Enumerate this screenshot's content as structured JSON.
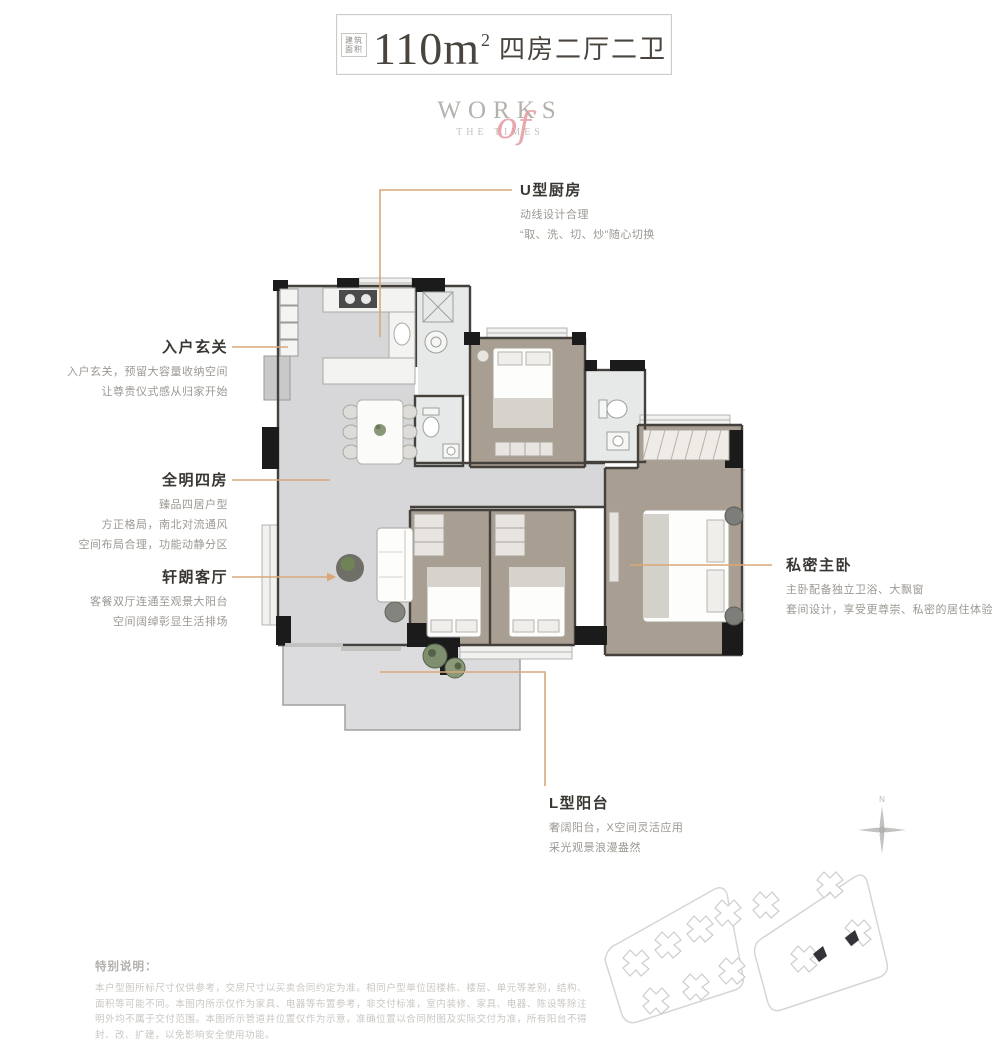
{
  "title_box": {
    "area_label_top": "建筑",
    "area_label_bottom": "面积",
    "area_number": "110",
    "area_unit": "m",
    "area_sup": "2",
    "layout_text": "四房二厅二卫"
  },
  "logo": {
    "top": "WORKS",
    "script": "of",
    "bottom": "THE TIMES"
  },
  "callouts": {
    "kitchen": {
      "title": "U型厨房",
      "line1": "动线设计合理",
      "line2": "“取、洗、切、炒”随心切换"
    },
    "foyer": {
      "title": "入户玄关",
      "line1": "入户玄关，预留大容量收纳空间",
      "line2": "让尊贵仪式感从归家开始"
    },
    "bedrooms": {
      "title": "全明四房",
      "line1": "臻品四居户型",
      "line2": "方正格局，南北对流通风",
      "line3": "空间布局合理，功能动静分区"
    },
    "living": {
      "title": "轩朗客厅",
      "line1": "客餐双厅连通至观景大阳台",
      "line2": "空间阔绰彰显生活排场"
    },
    "master": {
      "title": "私密主卧",
      "line1": "主卧配备独立卫浴、大飘窗",
      "line2": "套间设计，享受更尊崇、私密的居住体验"
    },
    "balcony": {
      "title": "L型阳台",
      "line1": "奢阔阳台，X空间灵活应用",
      "line2": "采光观景浪漫盎然"
    }
  },
  "compass": {
    "north_label": "N"
  },
  "disclaimer": {
    "title": "特别说明：",
    "body": "本户型图所标尺寸仅供参考，交房尺寸以买卖合同约定为准。相同户型单位因楼栋、楼层、单元等差别，结构、面积等可能不同。本图内所示仅作为家具、电器等布置参考，非交付标准，室内装修、家具、电器、陈设等除注明外均不属于交付范围。本图所示管道井位置仅作为示意，准确位置以合同附图及实际交付为准，所有阳台不得封、改、扩建，以免影响安全使用功能。"
  },
  "colors": {
    "leader": "#d9a87a",
    "ink": "#3b3733",
    "muted": "#9c9893",
    "faint": "#cac7c3",
    "logo_gray": "#b5b1ad",
    "logo_pink": "#e59aa2",
    "wall": "#1b1b1b",
    "tile": "#d7d7d9",
    "wood": "#aaa093"
  }
}
